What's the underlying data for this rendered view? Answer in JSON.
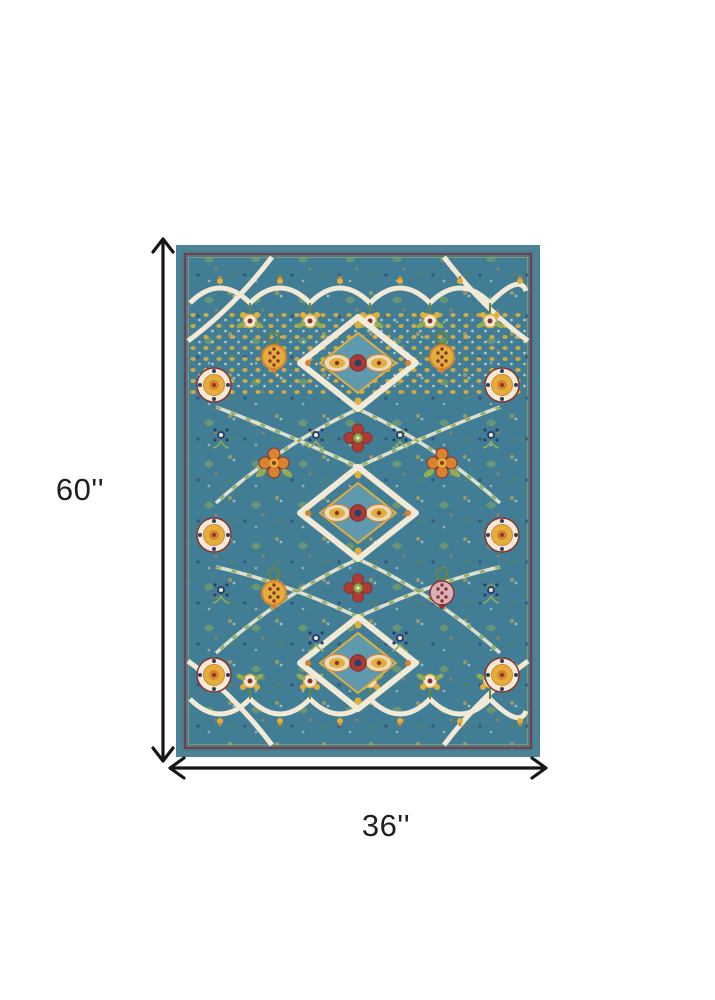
{
  "dimensions": {
    "height_label": "60''",
    "width_label": "36''"
  },
  "icons": {
    "height_arrow": "double-headed-vertical-arrow",
    "width_arrow": "double-headed-horizontal-arrow"
  },
  "colors": {
    "background": "#ffffff",
    "arrow": "#161616",
    "label-text": "#1f1f1f",
    "rug-edge": "#4d8396",
    "rug-field": "#417e95",
    "rug-teal-light": "#5f99ad",
    "rug-ivory": "#f2ead6",
    "rug-cream": "#e7dabd",
    "rug-gold": "#e2af3c",
    "rug-orange": "#d9822f",
    "rug-red": "#b03a32",
    "rug-maroon": "#8a3230",
    "rug-green": "#93ac53",
    "rug-olive": "#68853c",
    "rug-navy": "#2a3f6d",
    "rug-pink": "#d9afba"
  }
}
